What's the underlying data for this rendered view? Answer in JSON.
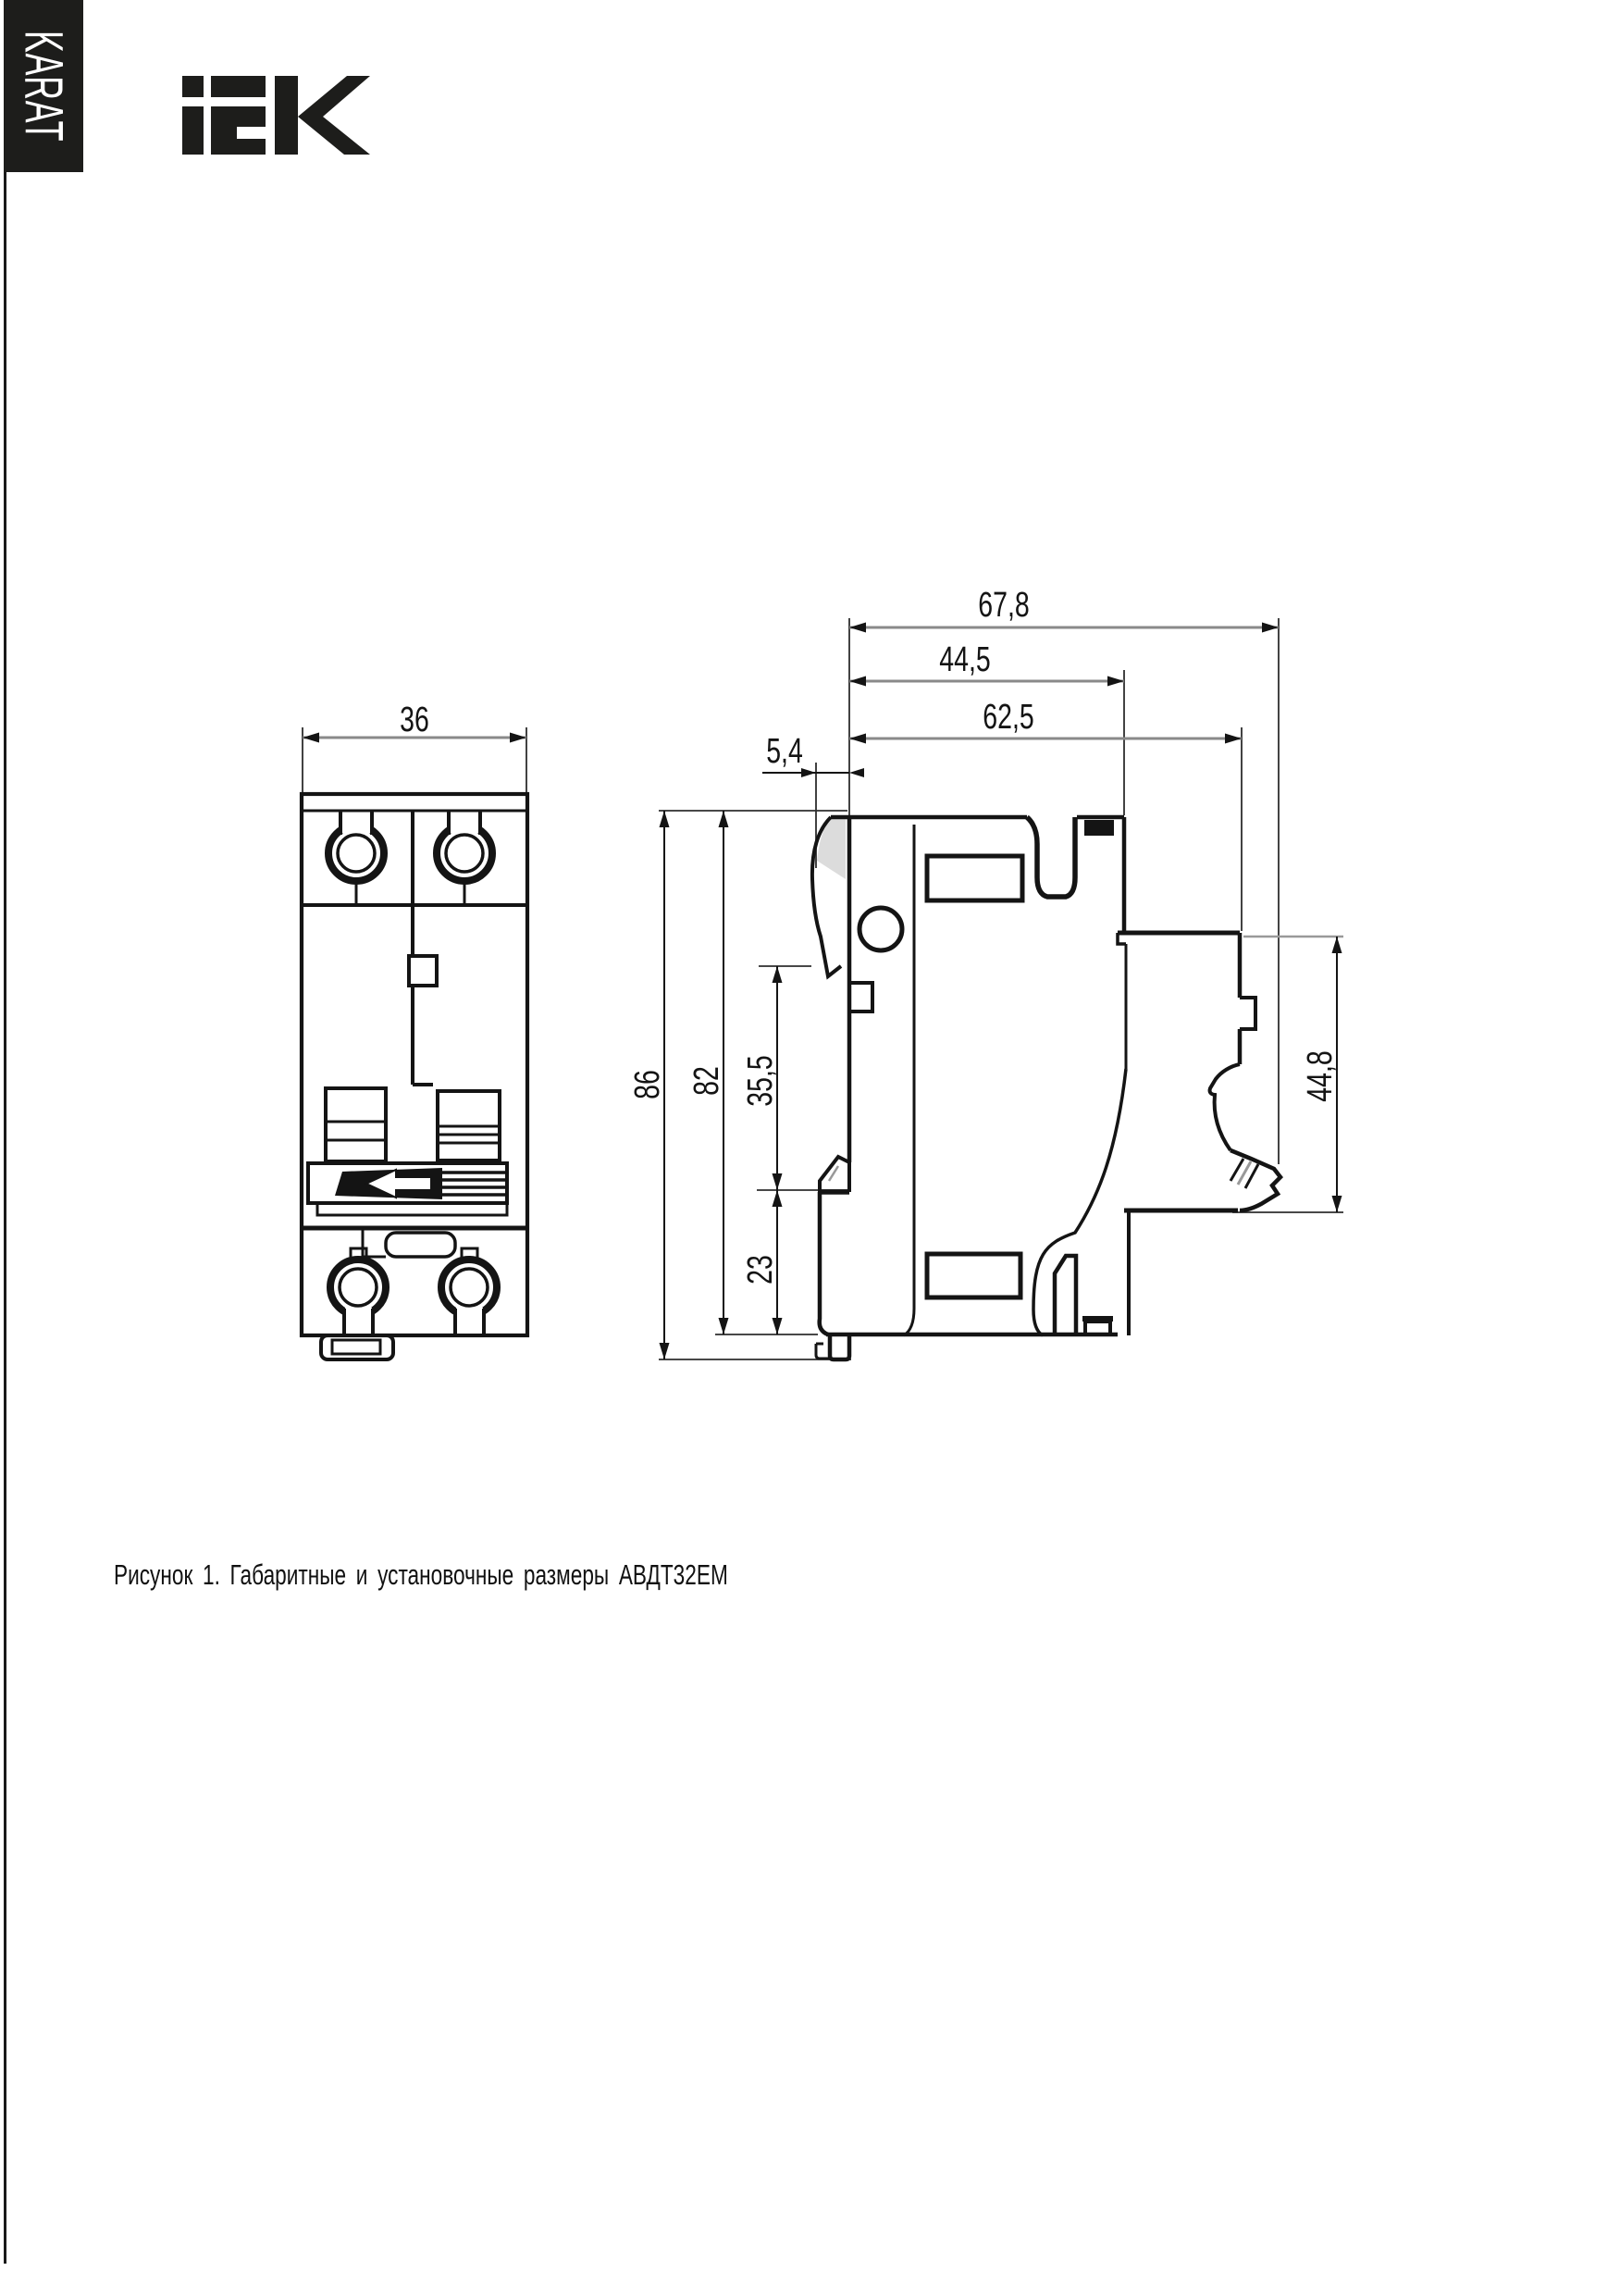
{
  "sidebar": {
    "label": "KARAT"
  },
  "logo": {
    "brand": "iEK"
  },
  "drawing": {
    "caption": "Рисунок 1. Габаритные и установочные размеры АВДТ32ЕМ",
    "front_view": {
      "width": "36"
    },
    "side_view": {
      "depth_total": "67,8",
      "depth_body": "44,5",
      "depth_plate": "62,5",
      "front_offset": "5,4",
      "height_total": "86",
      "height_body": "82",
      "rail_upper": "35,5",
      "rail_lower": "23",
      "plate_height": "44,8"
    }
  },
  "colors": {
    "ink": "#141414",
    "dim_line": "#8a8a8a",
    "shade": "#dcdcdc",
    "bar": "#1d1d1b"
  }
}
